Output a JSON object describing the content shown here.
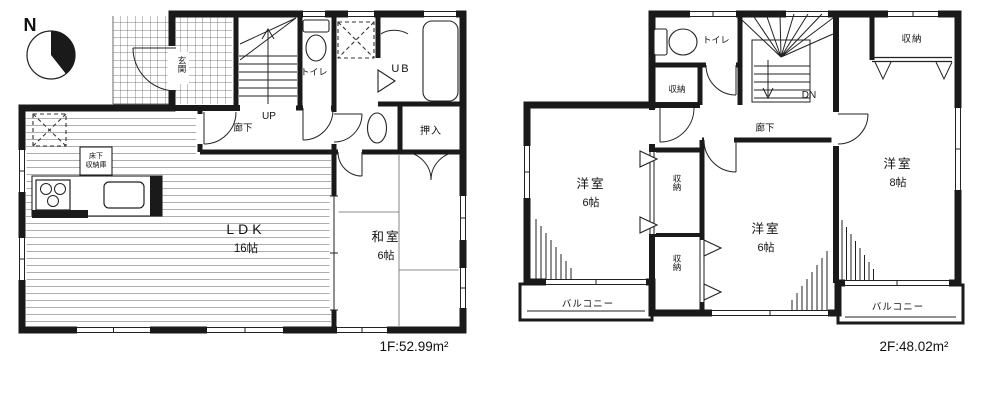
{
  "compass": {
    "north_label": "N"
  },
  "floor1": {
    "area_label": "1F:52.99m²",
    "ldk_name": "LDK",
    "ldk_size": "16帖",
    "washitsu_name": "和室",
    "washitsu_size": "6帖",
    "genkan": "玄関",
    "hallway": "廊下",
    "toilet": "トイレ",
    "bath": "UB",
    "closet": "押入",
    "stairs_up": "UP",
    "floor_storage_line1": "床下",
    "floor_storage_line2": "収納庫"
  },
  "floor2": {
    "area_label": "2F:48.02m²",
    "toilet": "トイレ",
    "hallway": "廊下",
    "stairs_down": "DN",
    "storage_hall": "収納",
    "storage_top_right": "収納",
    "storage_mid_upper": "収納",
    "storage_mid_lower": "収納",
    "room_left_name": "洋室",
    "room_left_size": "6帖",
    "room_mid_name": "洋室",
    "room_mid_size": "6帖",
    "room_right_name": "洋室",
    "room_right_size": "8帖",
    "balcony_left": "バルコニー",
    "balcony_right": "バルコニー"
  }
}
